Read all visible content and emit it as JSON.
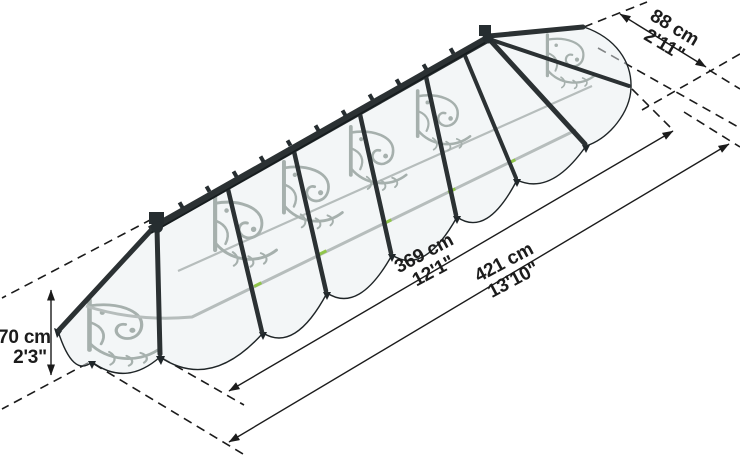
{
  "diagram": {
    "dimensions": {
      "depth": {
        "metric": "88 cm",
        "imperial": "2'11\""
      },
      "inner_width": {
        "metric": "369 cm",
        "imperial": "12'1\""
      },
      "outer_width": {
        "metric": "421 cm",
        "imperial": "13'10\""
      },
      "height": {
        "metric": "70 cm",
        "imperial": "2'3\""
      }
    },
    "colors": {
      "frame": "#2b3133",
      "dimension_line": "#1b1b1b",
      "ornament": "#a6b0ad",
      "panel": "#e8edef",
      "gutter": "#b6bdbc",
      "accent_green": "#8cc63e",
      "background": "#ffffff"
    }
  }
}
